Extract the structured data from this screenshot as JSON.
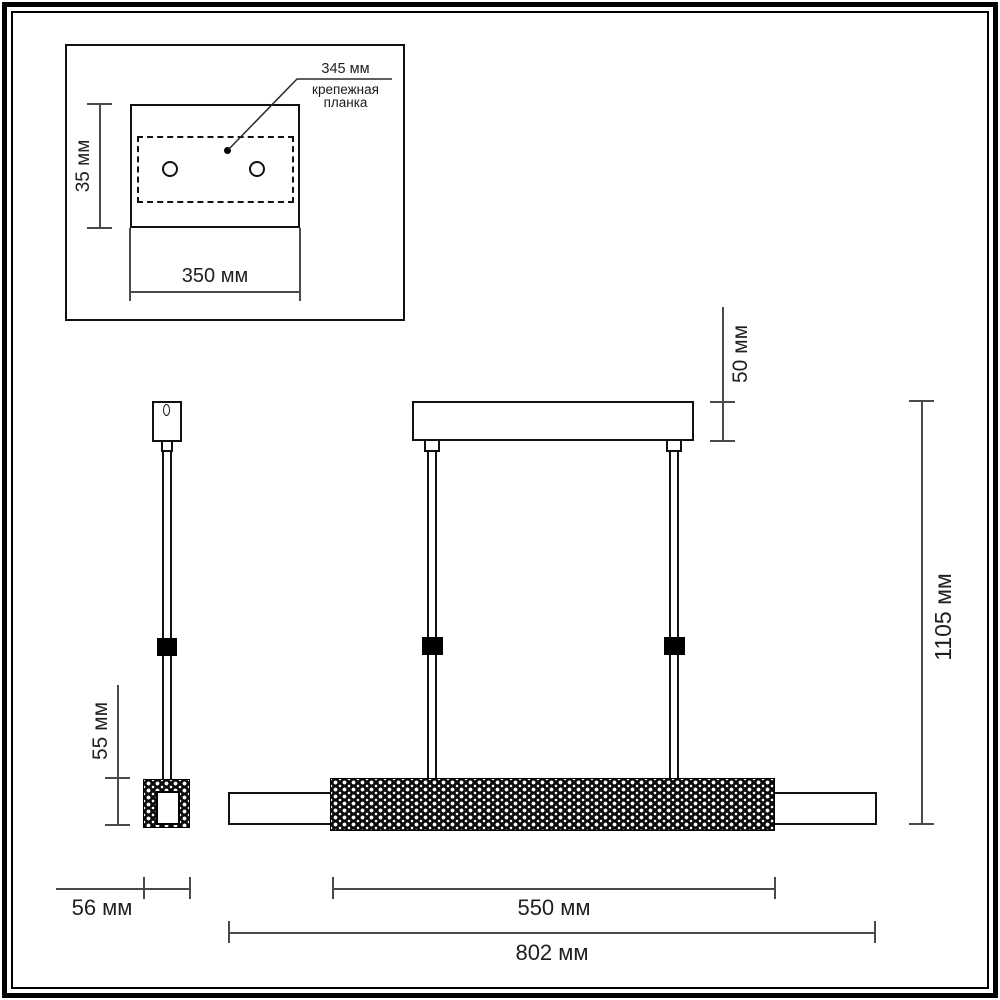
{
  "document": {
    "type": "pendant-lamp dimensional drawing",
    "colors": {
      "background": "#ffffff",
      "outline": "#111111",
      "dimension_line": "#4a4a4a",
      "solid_fill": "#000000"
    }
  },
  "inset": {
    "bracket_length_label": "345 мм",
    "bracket_caption": [
      "крепежная",
      "планка"
    ],
    "plate_height_label": "35 мм",
    "plate_width_label": "350 мм"
  },
  "front_view": {
    "canopy_height_label": "50 мм",
    "total_height_label": "1105 мм",
    "led_section_length_label": "550 мм",
    "total_length_label": "802 мм"
  },
  "side_view": {
    "endcap_height_label": "55 мм",
    "endcap_width_label": "56 мм"
  }
}
